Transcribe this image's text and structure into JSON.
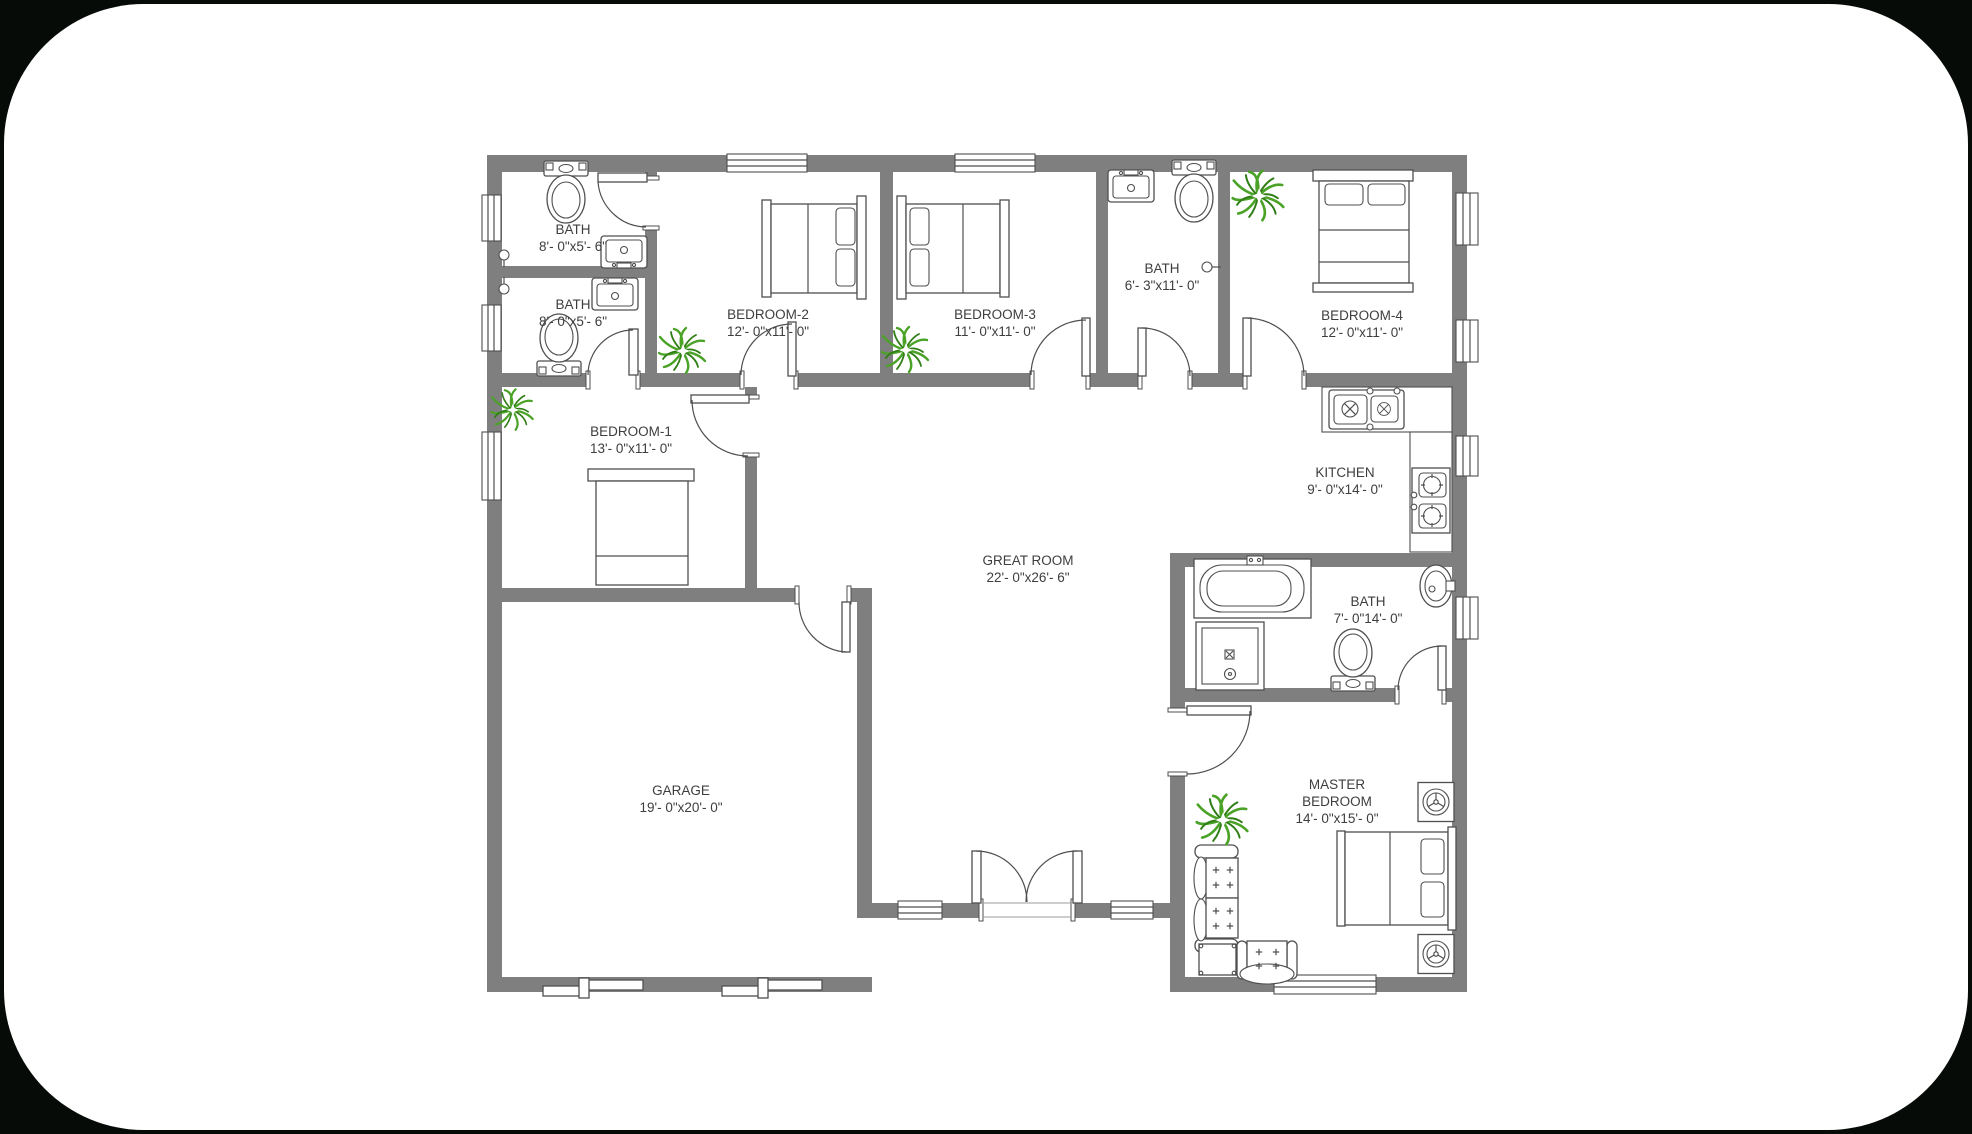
{
  "page": {
    "background": "#070b07",
    "sheet_color": "#ffffff"
  },
  "plan": {
    "wall_color": "#7f7f7f",
    "line_color": "#4f4f4f",
    "plant_colors": {
      "light": "#4aa226",
      "dark": "#2f7d15"
    },
    "rooms": [
      {
        "id": "bath-1",
        "name": "BATH",
        "dims": "8'- 0\"x5'- 6\""
      },
      {
        "id": "bath-2",
        "name": "BATH",
        "dims": "8'- 0\"x5'- 6\""
      },
      {
        "id": "bedroom-2",
        "name": "BEDROOM-2",
        "dims": "12'- 0\"x11'- 0\""
      },
      {
        "id": "bedroom-3",
        "name": "BEDROOM-3",
        "dims": "11'- 0\"x11'- 0\""
      },
      {
        "id": "bath-3",
        "name": "BATH",
        "dims": "6'- 3\"x11'- 0\""
      },
      {
        "id": "bedroom-4",
        "name": "BEDROOM-4",
        "dims": "12'- 0\"x11'- 0\""
      },
      {
        "id": "bedroom-1",
        "name": "BEDROOM-1",
        "dims": "13'- 0\"x11'- 0\""
      },
      {
        "id": "kitchen",
        "name": "KITCHEN",
        "dims": "9'- 0\"x14'- 0\""
      },
      {
        "id": "great-room",
        "name": "GREAT ROOM",
        "dims": "22'- 0\"x26'- 6\""
      },
      {
        "id": "garage",
        "name": "GARAGE",
        "dims": "19'- 0\"x20'- 0\""
      },
      {
        "id": "bath-4",
        "name": "BATH",
        "dims": "7'- 0\"14'- 0\""
      },
      {
        "id": "master-bedroom",
        "name_line1": "MASTER",
        "name_line2": "BEDROOM",
        "dims": "14'- 0\"x15'- 0\""
      }
    ]
  }
}
